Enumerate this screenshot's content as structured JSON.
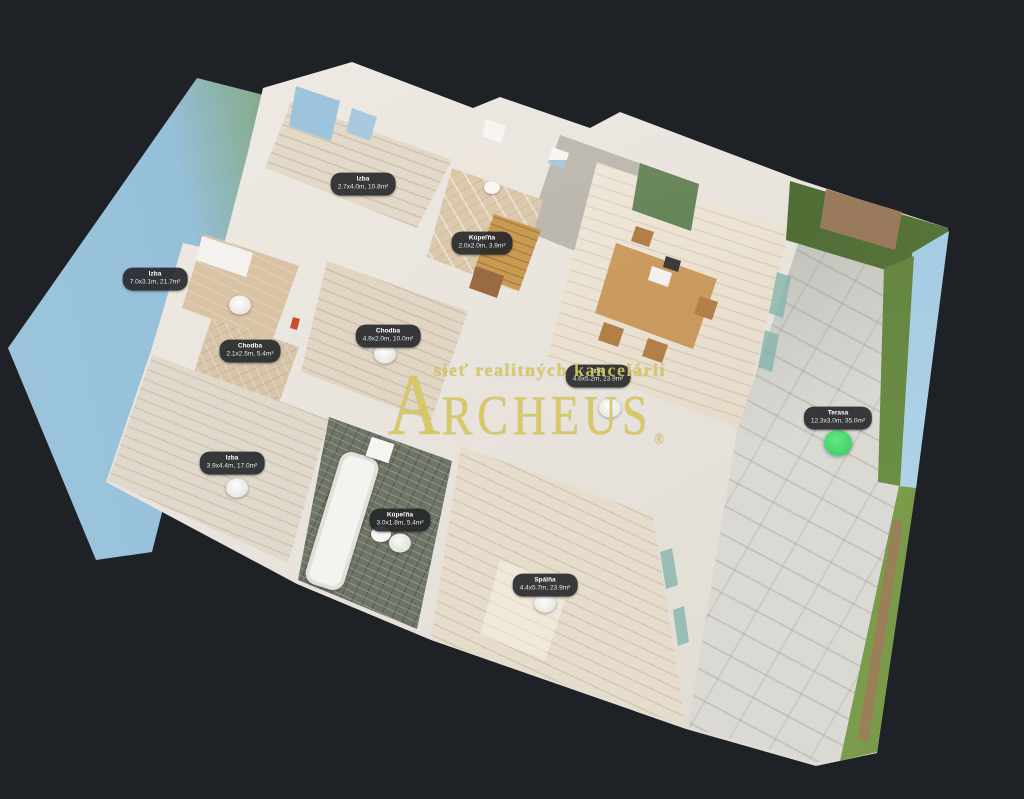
{
  "scene": {
    "background": "#1e2125",
    "watermark": {
      "tagline": "sieť realitných kancelárií",
      "brand": "ARCHEUS",
      "registered": "®",
      "color": "#d8c75e"
    },
    "room_labels": [
      {
        "name": "Izba",
        "dims": "7.0x3.1m, 21.7m²",
        "x": 155,
        "y": 279
      },
      {
        "name": "Izba",
        "dims": "2.7x4.0m, 10.8m²",
        "x": 363,
        "y": 184
      },
      {
        "name": "Kúpeľňa",
        "dims": "2.0x2.0m, 3.9m²",
        "x": 482,
        "y": 243
      },
      {
        "name": "Chodba",
        "dims": "2.1x2.5m, 5.4m²",
        "x": 250,
        "y": 351
      },
      {
        "name": "Chodba",
        "dims": "4.9x2.0m, 10.0m²",
        "x": 388,
        "y": 336
      },
      {
        "name": "Izba",
        "dims": "4.6x5.2m, 23.9m²",
        "x": 598,
        "y": 376
      },
      {
        "name": "Izba",
        "dims": "3.9x4.4m, 17.0m²",
        "x": 232,
        "y": 463
      },
      {
        "name": "Kúpeľňa",
        "dims": "3.0x1.8m, 5.4m²",
        "x": 400,
        "y": 520
      },
      {
        "name": "Spálňa",
        "dims": "4.4x5.7m, 23.9m²",
        "x": 545,
        "y": 585
      },
      {
        "name": "Terasa",
        "dims": "12.3x3.0m, 35.0m²",
        "x": 838,
        "y": 418
      }
    ],
    "sweep_markers": [
      {
        "x": 240,
        "y": 305
      },
      {
        "x": 385,
        "y": 354
      },
      {
        "x": 237,
        "y": 488
      },
      {
        "x": 400,
        "y": 543
      },
      {
        "x": 610,
        "y": 408
      },
      {
        "x": 545,
        "y": 603
      }
    ],
    "active_marker": {
      "x": 838,
      "y": 443,
      "color": "#3bd465"
    }
  }
}
